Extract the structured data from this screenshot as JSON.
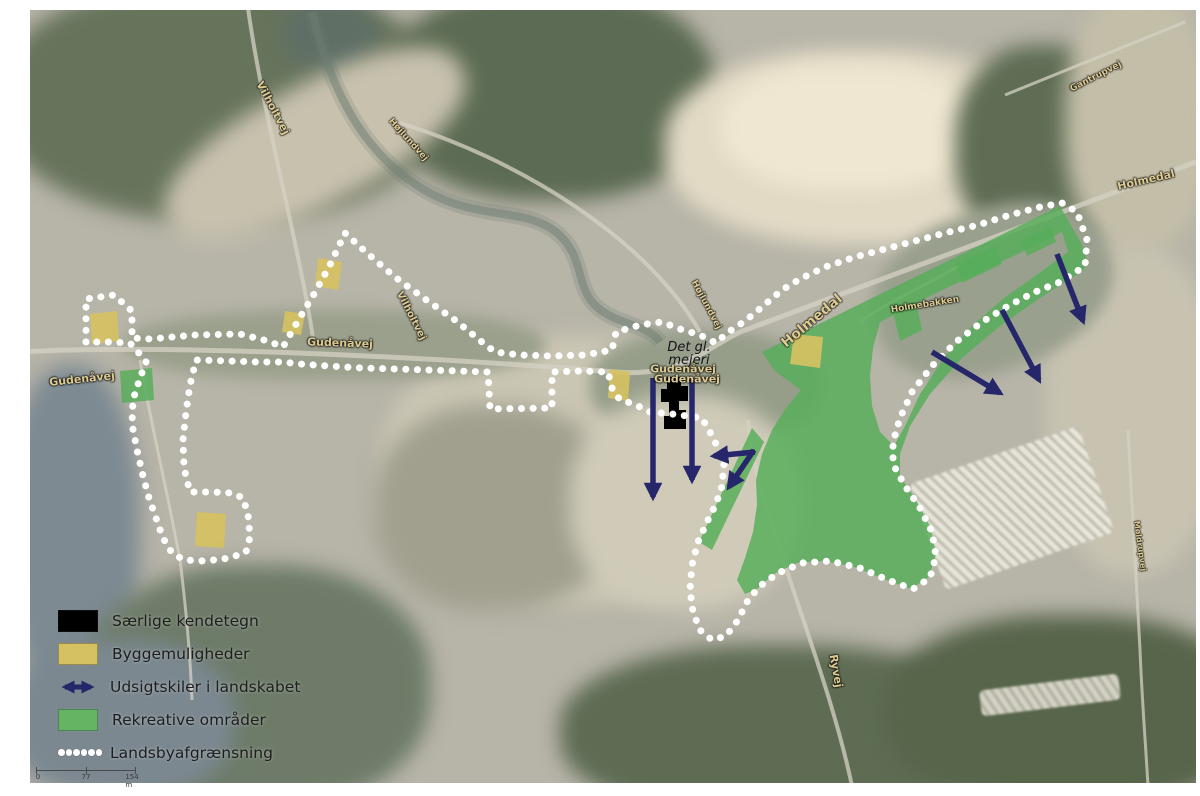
{
  "figure": {
    "type": "village-plan-aerial-map"
  },
  "colors": {
    "green_area": "#55ad59",
    "yellow_area": "#d5c162",
    "arrow_navy": "#26266b",
    "boundary_white": "#ffffff",
    "special_black": "#000000",
    "road_label": "#decb92",
    "legend_text": "#1e1e1e"
  },
  "legend": {
    "items": [
      {
        "swatch": "black-rect",
        "label": "Særlige kendetegn"
      },
      {
        "swatch": "tan-rect",
        "label": "Byggemuligheder"
      },
      {
        "swatch": "blue-double-arrow",
        "label": "Udsigtskiler i landskabet"
      },
      {
        "swatch": "green-rect",
        "label": "Rekreative områder"
      },
      {
        "swatch": "white-dots",
        "label": "Landsbyafgrænsning"
      }
    ]
  },
  "scalebar": {
    "start": "0",
    "mid": "77",
    "end": "154 m"
  },
  "labels": {
    "road_labels": [
      {
        "text": "Vilholtvej",
        "x": 273,
        "y": 108,
        "rot": 62,
        "size": 11
      },
      {
        "text": "Højlundvej",
        "x": 408,
        "y": 140,
        "rot": 48,
        "size": 9
      },
      {
        "text": "Gudenåvej",
        "x": 82,
        "y": 379,
        "rot": -6,
        "size": 11
      },
      {
        "text": "Gudenåvej",
        "x": 340,
        "y": 343,
        "rot": 2,
        "size": 11
      },
      {
        "text": "Vilholtvej",
        "x": 411,
        "y": 316,
        "rot": 63,
        "size": 10
      },
      {
        "text": "Gudenåvej",
        "x": 683,
        "y": 369,
        "rot": 0,
        "size": 11
      },
      {
        "text": "Gudenåvej",
        "x": 687,
        "y": 379,
        "rot": 0,
        "size": 11
      },
      {
        "text": "Højlundvej",
        "x": 706,
        "y": 305,
        "rot": 62,
        "size": 9
      },
      {
        "text": "Holmedal",
        "x": 812,
        "y": 321,
        "rot": -40,
        "size": 14
      },
      {
        "text": "Holmebakken",
        "x": 925,
        "y": 305,
        "rot": -9,
        "size": 9
      },
      {
        "text": "Holmedal",
        "x": 1146,
        "y": 180,
        "rot": -13,
        "size": 11
      },
      {
        "text": "Gantrupvej",
        "x": 1096,
        "y": 77,
        "rot": -27,
        "size": 9
      },
      {
        "text": "Ryvej",
        "x": 836,
        "y": 671,
        "rot": 80,
        "size": 11
      },
      {
        "text": "Møldrupvej",
        "x": 1140,
        "y": 546,
        "rot": 82,
        "size": 8
      }
    ],
    "poi": {
      "line1": "Det gl.",
      "line2": "mejeri",
      "x": 689,
      "y": 354
    }
  },
  "overlays": {
    "boundary_points": [
      [
        86,
        342
      ],
      [
        86,
        299
      ],
      [
        114,
        295
      ],
      [
        132,
        311
      ],
      [
        132,
        338
      ],
      [
        150,
        339
      ],
      [
        195,
        335
      ],
      [
        240,
        334
      ],
      [
        268,
        341
      ],
      [
        283,
        347
      ],
      [
        299,
        319
      ],
      [
        314,
        294
      ],
      [
        329,
        267
      ],
      [
        345,
        233
      ],
      [
        367,
        253
      ],
      [
        395,
        277
      ],
      [
        425,
        299
      ],
      [
        455,
        320
      ],
      [
        482,
        342
      ],
      [
        495,
        352
      ],
      [
        520,
        355
      ],
      [
        552,
        356
      ],
      [
        585,
        355
      ],
      [
        612,
        350
      ],
      [
        616,
        332
      ],
      [
        640,
        325
      ],
      [
        662,
        322
      ],
      [
        680,
        329
      ],
      [
        700,
        335
      ],
      [
        716,
        343
      ],
      [
        727,
        333
      ],
      [
        745,
        321
      ],
      [
        762,
        307
      ],
      [
        782,
        290
      ],
      [
        800,
        279
      ],
      [
        825,
        267
      ],
      [
        855,
        257
      ],
      [
        885,
        249
      ],
      [
        915,
        241
      ],
      [
        945,
        233
      ],
      [
        978,
        225
      ],
      [
        1010,
        215
      ],
      [
        1040,
        207
      ],
      [
        1062,
        203
      ],
      [
        1077,
        212
      ],
      [
        1087,
        240
      ],
      [
        1085,
        266
      ],
      [
        1060,
        282
      ],
      [
        1035,
        292
      ],
      [
        1008,
        306
      ],
      [
        982,
        322
      ],
      [
        956,
        342
      ],
      [
        932,
        366
      ],
      [
        912,
        392
      ],
      [
        900,
        418
      ],
      [
        893,
        442
      ],
      [
        893,
        464
      ],
      [
        905,
        486
      ],
      [
        920,
        508
      ],
      [
        932,
        532
      ],
      [
        936,
        556
      ],
      [
        930,
        578
      ],
      [
        913,
        589
      ],
      [
        888,
        580
      ],
      [
        860,
        568
      ],
      [
        830,
        561
      ],
      [
        802,
        563
      ],
      [
        778,
        573
      ],
      [
        760,
        586
      ],
      [
        748,
        600
      ],
      [
        738,
        620
      ],
      [
        726,
        636
      ],
      [
        712,
        640
      ],
      [
        700,
        630
      ],
      [
        693,
        612
      ],
      [
        690,
        590
      ],
      [
        692,
        565
      ],
      [
        698,
        542
      ],
      [
        707,
        522
      ],
      [
        716,
        504
      ],
      [
        722,
        486
      ],
      [
        724,
        464
      ],
      [
        718,
        448
      ],
      [
        710,
        432
      ],
      [
        702,
        418
      ],
      [
        672,
        414
      ],
      [
        650,
        412
      ],
      [
        634,
        404
      ],
      [
        620,
        400
      ],
      [
        612,
        388
      ],
      [
        608,
        372
      ],
      [
        580,
        371
      ],
      [
        552,
        372
      ],
      [
        552,
        408
      ],
      [
        490,
        409
      ],
      [
        488,
        372
      ],
      [
        458,
        371
      ],
      [
        428,
        370
      ],
      [
        396,
        369
      ],
      [
        362,
        368
      ],
      [
        328,
        366
      ],
      [
        300,
        364
      ],
      [
        283,
        362
      ],
      [
        258,
        362
      ],
      [
        230,
        361
      ],
      [
        196,
        360
      ],
      [
        190,
        385
      ],
      [
        186,
        412
      ],
      [
        183,
        440
      ],
      [
        184,
        468
      ],
      [
        190,
        492
      ],
      [
        212,
        492
      ],
      [
        232,
        493
      ],
      [
        243,
        498
      ],
      [
        248,
        514
      ],
      [
        250,
        537
      ],
      [
        246,
        552
      ],
      [
        230,
        558
      ],
      [
        205,
        561
      ],
      [
        184,
        560
      ],
      [
        172,
        553
      ],
      [
        163,
        538
      ],
      [
        156,
        518
      ],
      [
        149,
        498
      ],
      [
        143,
        476
      ],
      [
        137,
        450
      ],
      [
        132,
        424
      ],
      [
        133,
        400
      ],
      [
        140,
        378
      ],
      [
        146,
        362
      ],
      [
        138,
        352
      ],
      [
        130,
        343
      ],
      [
        108,
        342
      ]
    ],
    "green_polygons": [
      [
        [
          120,
          371
        ],
        [
          152,
          368
        ],
        [
          154,
          400
        ],
        [
          122,
          403
        ]
      ],
      [
        [
          752,
          428
        ],
        [
          764,
          442
        ],
        [
          712,
          550
        ],
        [
          699,
          542
        ]
      ],
      [
        [
          893,
          312
        ],
        [
          916,
          301
        ],
        [
          922,
          330
        ],
        [
          900,
          341
        ]
      ],
      [
        [
          956,
          264
        ],
        [
          996,
          246
        ],
        [
          1002,
          264
        ],
        [
          962,
          283
        ]
      ],
      [
        [
          1021,
          240
        ],
        [
          1051,
          226
        ],
        [
          1056,
          242
        ],
        [
          1027,
          256
        ]
      ]
    ],
    "green_big": {
      "outer": [
        [
          762,
          352
        ],
        [
          1060,
          206
        ],
        [
          1086,
          252
        ],
        [
          1084,
          270
        ],
        [
          1040,
          298
        ],
        [
          1000,
          326
        ],
        [
          962,
          358
        ],
        [
          930,
          394
        ],
        [
          910,
          426
        ],
        [
          900,
          454
        ],
        [
          900,
          476
        ],
        [
          916,
          500
        ],
        [
          930,
          526
        ],
        [
          936,
          554
        ],
        [
          929,
          577
        ],
        [
          911,
          589
        ],
        [
          884,
          579
        ],
        [
          854,
          567
        ],
        [
          824,
          561
        ],
        [
          797,
          563
        ],
        [
          774,
          574
        ],
        [
          757,
          589
        ],
        [
          745,
          594
        ],
        [
          737,
          580
        ],
        [
          745,
          558
        ],
        [
          753,
          532
        ],
        [
          757,
          505
        ],
        [
          756,
          480
        ],
        [
          762,
          454
        ],
        [
          772,
          430
        ],
        [
          786,
          408
        ],
        [
          801,
          390
        ],
        [
          775,
          371
        ]
      ],
      "hole": [
        [
          880,
          322
        ],
        [
          930,
          296
        ],
        [
          980,
          272
        ],
        [
          1030,
          248
        ],
        [
          1062,
          232
        ],
        [
          1068,
          252
        ],
        [
          1038,
          274
        ],
        [
          1004,
          298
        ],
        [
          972,
          326
        ],
        [
          944,
          358
        ],
        [
          920,
          394
        ],
        [
          905,
          426
        ],
        [
          894,
          446
        ],
        [
          880,
          432
        ],
        [
          872,
          406
        ],
        [
          870,
          376
        ],
        [
          873,
          348
        ]
      ]
    },
    "yellow_patches": [
      [
        [
          90,
          314
        ],
        [
          117,
          311
        ],
        [
          119,
          341
        ],
        [
          92,
          344
        ]
      ],
      [
        [
          318,
          258
        ],
        [
          342,
          262
        ],
        [
          338,
          290
        ],
        [
          315,
          286
        ]
      ],
      [
        [
          285,
          311
        ],
        [
          305,
          314
        ],
        [
          301,
          335
        ],
        [
          282,
          332
        ]
      ],
      [
        [
          610,
          369
        ],
        [
          630,
          372
        ],
        [
          628,
          401
        ],
        [
          608,
          398
        ]
      ],
      [
        [
          794,
          334
        ],
        [
          823,
          337
        ],
        [
          820,
          368
        ],
        [
          790,
          364
        ]
      ],
      [
        [
          197,
          512
        ],
        [
          226,
          514
        ],
        [
          224,
          548
        ],
        [
          195,
          546
        ]
      ]
    ],
    "special_building": [
      [
        667,
        377
      ],
      [
        681,
        377
      ],
      [
        681,
        386
      ],
      [
        688,
        386
      ],
      [
        688,
        401
      ],
      [
        679,
        401
      ],
      [
        679,
        410
      ],
      [
        686,
        410
      ],
      [
        686,
        429
      ],
      [
        664,
        429
      ],
      [
        664,
        416
      ],
      [
        669,
        416
      ],
      [
        669,
        402
      ],
      [
        661,
        402
      ],
      [
        661,
        389
      ],
      [
        667,
        389
      ]
    ],
    "view_arrows": [
      [
        653,
        378,
        653,
        497
      ],
      [
        692,
        380,
        692,
        480
      ],
      [
        755,
        452,
        714,
        456
      ],
      [
        754,
        450,
        729,
        487
      ],
      [
        932,
        352,
        1000,
        393
      ],
      [
        1002,
        310,
        1039,
        380
      ],
      [
        1057,
        254,
        1083,
        321
      ]
    ]
  }
}
